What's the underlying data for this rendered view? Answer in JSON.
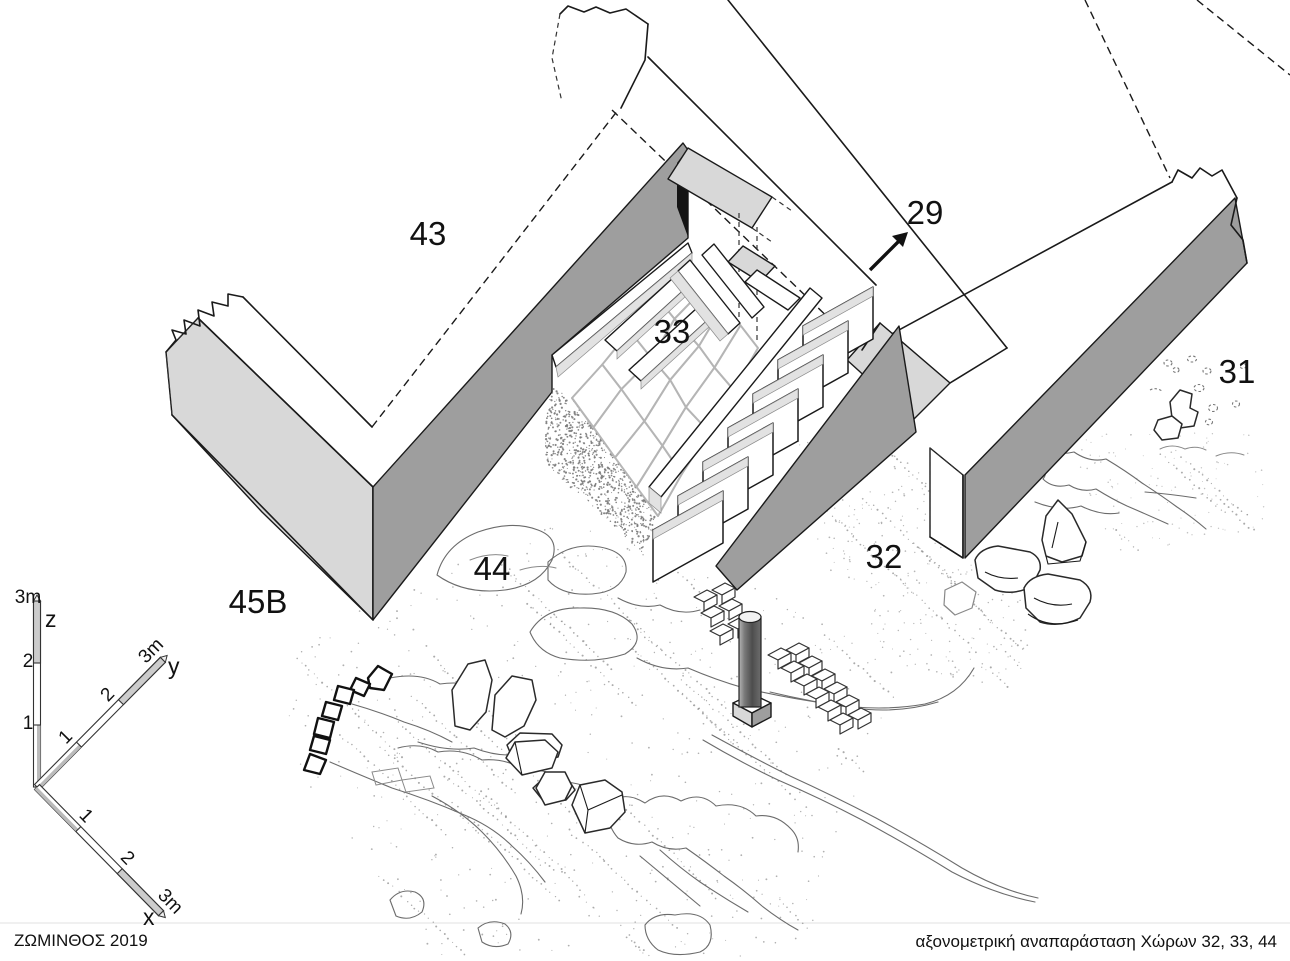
{
  "footer": {
    "left": "ΖΩΜΙΝΘΟΣ 2019",
    "right": "αξονομετρική αναπαράσταση Χώρων 32, 33, 44"
  },
  "labels": [
    {
      "id": "room-label-43",
      "text": "43",
      "x": 428,
      "y": 245
    },
    {
      "id": "room-label-29",
      "text": "29",
      "x": 925,
      "y": 224
    },
    {
      "id": "room-label-33",
      "text": "33",
      "x": 672,
      "y": 343
    },
    {
      "id": "room-label-31",
      "text": "31",
      "x": 1237,
      "y": 383
    },
    {
      "id": "room-label-32",
      "text": "32",
      "x": 884,
      "y": 568
    },
    {
      "id": "room-label-44",
      "text": "44",
      "x": 492,
      "y": 580
    },
    {
      "id": "room-label-45B",
      "text": "45B",
      "x": 258,
      "y": 613
    }
  ],
  "axis": {
    "x": {
      "name": "x",
      "ticks": [
        "1",
        "2",
        "3m"
      ]
    },
    "y": {
      "name": "y",
      "ticks": [
        "1",
        "2",
        "3m"
      ]
    },
    "z": {
      "name": "z",
      "ticks": [
        "1",
        "2",
        "3m"
      ]
    }
  },
  "colors": {
    "face_light": "#d8d8d8",
    "face_dark": "#9e9e9e",
    "riser": "#e2e2e2",
    "paving_line": "#b5b5b5",
    "stipple": "#8f8f8f"
  }
}
